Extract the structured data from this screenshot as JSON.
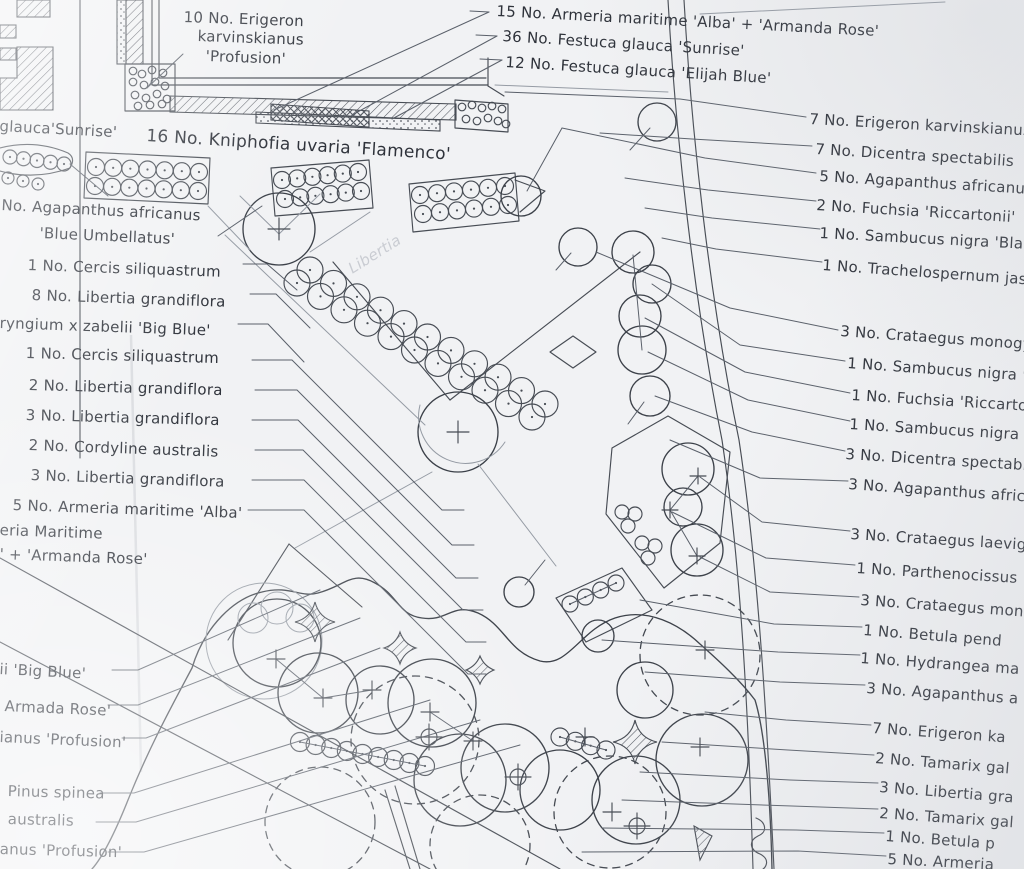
{
  "document": {
    "kind": "hand-drawn landscape planting plan",
    "colors": {
      "paper": "#f1f2f4",
      "ink": "#474c54",
      "pencil": "#9298a1"
    }
  },
  "labels": {
    "top": [
      {
        "text": "15 No. Armeria maritime 'Alba' + 'Armanda Rose'",
        "x": 497,
        "y": 2,
        "r": 3
      },
      {
        "text": "36 No. Festuca glauca 'Sunrise'",
        "x": 503,
        "y": 27,
        "r": 3.5
      },
      {
        "text": "12 No. Festuca glauca 'Elijah Blue'",
        "x": 506,
        "y": 53,
        "r": 3.5
      },
      {
        "text": "10 No. Erigeron",
        "x": 184,
        "y": 8,
        "r": 2
      },
      {
        "text": "karvinskianus",
        "x": 198,
        "y": 27,
        "r": 2
      },
      {
        "text": "'Profusion'",
        "x": 206,
        "y": 47,
        "r": 2
      },
      {
        "text": "glauca'Sunrise'",
        "x": 0,
        "y": 117,
        "r": 3
      },
      {
        "text": "16 No. Kniphofia uvaria 'Flamenco'",
        "x": 147,
        "y": 126,
        "r": 3.5,
        "fs": 17
      }
    ],
    "left": [
      {
        "text": "No. Agapanthus africanus",
        "x": 2,
        "y": 196,
        "r": 3
      },
      {
        "text": "'Blue Umbellatus'",
        "x": 40,
        "y": 224,
        "r": 2.5
      },
      {
        "text": "1 No. Cercis siliquastrum",
        "x": 28,
        "y": 256,
        "r": 2
      },
      {
        "text": "8 No. Libertia grandiflora",
        "x": 32,
        "y": 286,
        "r": 2
      },
      {
        "text": "ryngium x zabelii 'Big Blue'",
        "x": 0,
        "y": 314,
        "r": 2
      },
      {
        "text": "1 No. Cercis siliquastrum",
        "x": 26,
        "y": 344,
        "r": 1.5
      },
      {
        "text": "2 No. Libertia grandiflora",
        "x": 29,
        "y": 376,
        "r": 1.5
      },
      {
        "text": "3 No. Libertia grandiflora",
        "x": 26,
        "y": 406,
        "r": 1.5
      },
      {
        "text": "2 No. Cordyline australis",
        "x": 29,
        "y": 436,
        "r": 2
      },
      {
        "text": "3 No. Libertia grandiflora",
        "x": 31,
        "y": 466,
        "r": 2
      },
      {
        "text": "5 No. Armeria maritime 'Alba'",
        "x": 13,
        "y": 496,
        "r": 2
      },
      {
        "text": "eria Maritime",
        "x": 0,
        "y": 521,
        "r": 2
      },
      {
        "text": "' + 'Armanda Rose'",
        "x": 0,
        "y": 545,
        "r": 2
      }
    ],
    "bottom_left": [
      {
        "text": "ii 'Big Blue'",
        "x": 0,
        "y": 660,
        "r": 3
      },
      {
        "text": "Armada Rose'",
        "x": 5,
        "y": 697,
        "r": 2.5
      },
      {
        "text": "ianus 'Profusion'",
        "x": 0,
        "y": 728,
        "r": 2.5
      },
      {
        "text": "Pinus spinea",
        "x": 8,
        "y": 782,
        "r": 1.5
      },
      {
        "text": "australis",
        "x": 8,
        "y": 810,
        "r": 1.5
      },
      {
        "text": "anus 'Profusion'",
        "x": 0,
        "y": 840,
        "r": 1.5
      }
    ],
    "right": [
      {
        "text": "7 No. Erigeron karvinskianus",
        "x": 810,
        "y": 110,
        "r": 3
      },
      {
        "text": "7 No. Dicentra spectabilis",
        "x": 816,
        "y": 140,
        "r": 3.5
      },
      {
        "text": "5 No. Agapanthus africanus",
        "x": 820,
        "y": 167,
        "r": 3.5
      },
      {
        "text": "2 No. Fuchsia 'Riccartonii'",
        "x": 817,
        "y": 196,
        "r": 3.5
      },
      {
        "text": "1 No. Sambucus nigra 'Bla",
        "x": 820,
        "y": 224,
        "r": 3
      },
      {
        "text": "1 No. Trachelospernum jas",
        "x": 823,
        "y": 256,
        "r": 4
      },
      {
        "text": "3 No. Crataegus monogy",
        "x": 841,
        "y": 322,
        "r": 4
      },
      {
        "text": "1 No. Sambucus nigra '",
        "x": 848,
        "y": 354,
        "r": 4
      },
      {
        "text": "1 No. Fuchsia 'Riccartoni",
        "x": 852,
        "y": 386,
        "r": 3.5
      },
      {
        "text": "1 No. Sambucus nigra '",
        "x": 850,
        "y": 415,
        "r": 3.5
      },
      {
        "text": "3 No. Dicentra spectabil",
        "x": 846,
        "y": 445,
        "r": 3.5
      },
      {
        "text": "3 No. Agapanthus afric",
        "x": 849,
        "y": 475,
        "r": 4
      },
      {
        "text": "3 No. Crataegus laevig",
        "x": 851,
        "y": 525,
        "r": 3.5
      },
      {
        "text": "1 No. Parthenocissus",
        "x": 857,
        "y": 559,
        "r": 3.5
      },
      {
        "text": "3 No. Crataegus mon",
        "x": 861,
        "y": 591,
        "r": 4
      },
      {
        "text": "1 No. Betula pend",
        "x": 864,
        "y": 621,
        "r": 4.5
      },
      {
        "text": "1 No. Hydrangea ma",
        "x": 861,
        "y": 649,
        "r": 4
      },
      {
        "text": "3 No. Agapanthus a",
        "x": 867,
        "y": 679,
        "r": 4
      },
      {
        "text": "7 No. Erigeron ka",
        "x": 873,
        "y": 719,
        "r": 4
      },
      {
        "text": "2 No. Tamarix gal",
        "x": 876,
        "y": 749,
        "r": 4.5
      },
      {
        "text": "3 No. Libertia gra",
        "x": 880,
        "y": 778,
        "r": 4.5
      },
      {
        "text": "2 No. Tamarix gal",
        "x": 880,
        "y": 804,
        "r": 4
      },
      {
        "text": "1 No. Betula p",
        "x": 886,
        "y": 827,
        "r": 4
      },
      {
        "text": "5 No. Armeria",
        "x": 888,
        "y": 850,
        "r": 3
      }
    ],
    "ghost": [
      {
        "text": "Libertia",
        "x": 345,
        "y": 262,
        "r": -32,
        "cls": "ghost"
      }
    ]
  }
}
